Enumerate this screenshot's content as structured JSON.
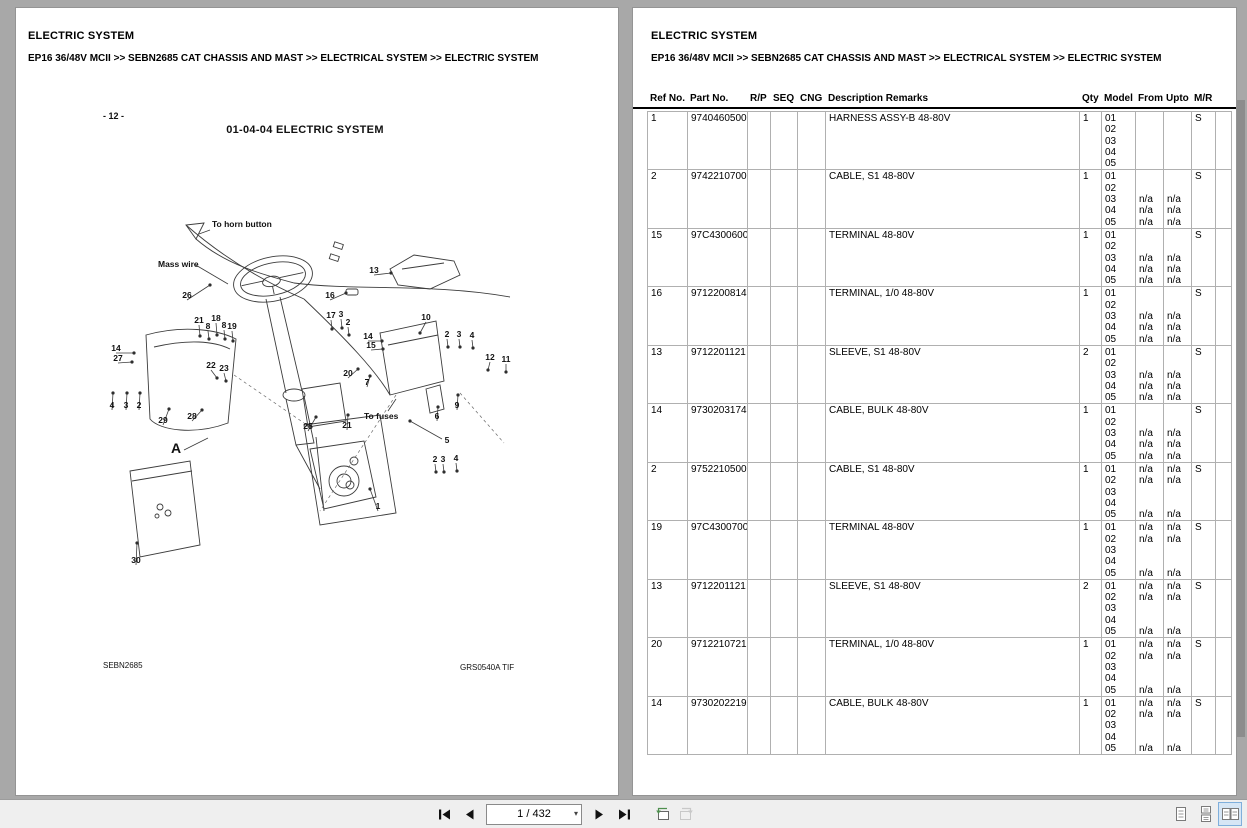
{
  "left_page": {
    "title": "ELECTRIC SYSTEM",
    "breadcrumb": "EP16 36/48V MCII >> SEBN2685 CAT CHASSIS AND MAST >> ELECTRICAL SYSTEM >> ELECTRIC SYSTEM",
    "diagram": {
      "page_number": "- 12 -",
      "title": "01-04-04 ELECTRIC SYSTEM",
      "footer_left": "SEBN2685",
      "footer_right": "GRS0540A TIF",
      "callouts": [
        {
          "t": "To horn button",
          "kind": "text",
          "x": 154,
          "y": 134,
          "sx": 152,
          "sy": 137,
          "ex": 141,
          "ey": 141
        },
        {
          "t": "Mass wire",
          "kind": "text",
          "x": 100,
          "y": 174,
          "sx": 136,
          "sy": 171,
          "ex": 170,
          "ey": 191
        },
        {
          "t": "26",
          "kind": "number",
          "x": 129,
          "y": 205,
          "ex": 152,
          "ey": 192
        },
        {
          "t": "21",
          "kind": "number",
          "x": 141,
          "y": 230,
          "ex": 142,
          "ey": 243
        },
        {
          "t": "8",
          "kind": "number",
          "x": 150,
          "y": 236,
          "ex": 151,
          "ey": 246
        },
        {
          "t": "18",
          "kind": "number",
          "x": 158,
          "y": 228,
          "ex": 159,
          "ey": 242
        },
        {
          "t": "8",
          "kind": "number",
          "x": 166,
          "y": 235,
          "ex": 167,
          "ey": 246
        },
        {
          "t": "19",
          "kind": "number",
          "x": 174,
          "y": 236,
          "ex": 175,
          "ey": 248
        },
        {
          "t": "14",
          "kind": "number",
          "x": 58,
          "y": 258,
          "ex": 76,
          "ey": 260
        },
        {
          "t": "27",
          "kind": "number",
          "x": 60,
          "y": 268,
          "ex": 74,
          "ey": 269
        },
        {
          "t": "16",
          "kind": "number",
          "x": 272,
          "y": 205,
          "ex": 288,
          "ey": 200
        },
        {
          "t": "17",
          "kind": "number",
          "x": 273,
          "y": 225,
          "ex": 274,
          "ey": 236
        },
        {
          "t": "3",
          "kind": "number",
          "x": 283,
          "y": 224,
          "ex": 284,
          "ey": 235
        },
        {
          "t": "2",
          "kind": "number",
          "x": 290,
          "y": 232,
          "ex": 291,
          "ey": 242
        },
        {
          "t": "13",
          "kind": "number",
          "x": 316,
          "y": 180,
          "ex": 333,
          "ey": 180
        },
        {
          "t": "10",
          "kind": "number",
          "x": 368,
          "y": 227,
          "ex": 362,
          "ey": 240
        },
        {
          "t": "14",
          "kind": "number",
          "x": 310,
          "y": 246,
          "ex": 324,
          "ey": 248
        },
        {
          "t": "15",
          "kind": "number",
          "x": 313,
          "y": 255,
          "ex": 325,
          "ey": 256
        },
        {
          "t": "2",
          "kind": "number",
          "x": 389,
          "y": 244,
          "ex": 390,
          "ey": 254
        },
        {
          "t": "3",
          "kind": "number",
          "x": 401,
          "y": 244,
          "ex": 402,
          "ey": 254
        },
        {
          "t": "4",
          "kind": "number",
          "x": 414,
          "y": 245,
          "ex": 415,
          "ey": 255
        },
        {
          "t": "12",
          "kind": "number",
          "x": 432,
          "y": 267,
          "ex": 430,
          "ey": 277
        },
        {
          "t": "11",
          "kind": "number",
          "x": 448,
          "y": 269,
          "ex": 448,
          "ey": 279
        },
        {
          "t": "20",
          "kind": "number",
          "x": 290,
          "y": 283,
          "ex": 300,
          "ey": 276
        },
        {
          "t": "7",
          "kind": "number",
          "x": 309,
          "y": 292,
          "ex": 312,
          "ey": 283
        },
        {
          "t": "22",
          "kind": "number",
          "x": 153,
          "y": 275,
          "ex": 159,
          "ey": 285
        },
        {
          "t": "23",
          "kind": "number",
          "x": 166,
          "y": 278,
          "ex": 168,
          "ey": 288
        },
        {
          "t": "28",
          "kind": "number",
          "x": 134,
          "y": 326,
          "ex": 144,
          "ey": 317
        },
        {
          "t": "29",
          "kind": "number",
          "x": 105,
          "y": 330,
          "ex": 111,
          "ey": 316
        },
        {
          "t": "4",
          "kind": "number",
          "x": 54,
          "y": 315,
          "ex": 55,
          "ey": 300
        },
        {
          "t": "3",
          "kind": "number",
          "x": 68,
          "y": 315,
          "ex": 69,
          "ey": 300
        },
        {
          "t": "2",
          "kind": "number",
          "x": 81,
          "y": 315,
          "ex": 82,
          "ey": 300
        },
        {
          "t": "A",
          "kind": "letter",
          "x": 118,
          "y": 360,
          "sx": 126,
          "sy": 357,
          "ex": 150,
          "ey": 345
        },
        {
          "t": "25",
          "kind": "number",
          "x": 250,
          "y": 336,
          "ex": 258,
          "ey": 324
        },
        {
          "t": "21",
          "kind": "number",
          "x": 289,
          "y": 335,
          "ex": 290,
          "ey": 322
        },
        {
          "t": "To fuses",
          "kind": "text",
          "x": 306,
          "y": 326,
          "sx": 330,
          "sy": 318,
          "ex": 338,
          "ey": 306
        },
        {
          "t": "6",
          "kind": "number",
          "x": 379,
          "y": 326,
          "ex": 380,
          "ey": 314
        },
        {
          "t": "9",
          "kind": "number",
          "x": 399,
          "y": 315,
          "ex": 400,
          "ey": 302
        },
        {
          "t": "5",
          "kind": "number",
          "x": 389,
          "y": 350,
          "sx": 384,
          "sy": 346,
          "ex": 352,
          "ey": 328
        },
        {
          "t": "2",
          "kind": "number",
          "x": 377,
          "y": 369,
          "ex": 378,
          "ey": 379
        },
        {
          "t": "3",
          "kind": "number",
          "x": 385,
          "y": 369,
          "ex": 386,
          "ey": 379
        },
        {
          "t": "4",
          "kind": "number",
          "x": 398,
          "y": 368,
          "ex": 399,
          "ey": 378
        },
        {
          "t": "1",
          "kind": "number",
          "x": 320,
          "y": 416,
          "ex": 312,
          "ey": 396
        },
        {
          "t": "30",
          "kind": "number",
          "x": 78,
          "y": 470,
          "ex": 79,
          "ey": 450
        }
      ]
    }
  },
  "right_page": {
    "title": "ELECTRIC SYSTEM",
    "breadcrumb": "EP16 36/48V MCII >> SEBN2685 CAT CHASSIS AND MAST >> ELECTRICAL SYSTEM >> ELECTRIC SYSTEM",
    "table": {
      "columns": [
        "Ref No.",
        "Part No.",
        "R/P",
        "SEQ",
        "CNG",
        "Description Remarks",
        "Qty",
        "Model",
        "From",
        "Upto",
        "M/R"
      ],
      "rows": [
        {
          "ref": "1",
          "part": "9740460500",
          "rp": "",
          "seq": "",
          "cng": "",
          "desc": "HARNESS ASSY-B 48-80V",
          "qty": "1",
          "model": [
            "01",
            "02",
            "03",
            "04",
            "05"
          ],
          "from": [
            "",
            "",
            "",
            "",
            ""
          ],
          "upto": [
            "",
            "",
            "",
            "",
            ""
          ],
          "mr": "S"
        },
        {
          "ref": "2",
          "part": "9742210700",
          "rp": "",
          "seq": "",
          "cng": "",
          "desc": "CABLE, S1 48-80V",
          "qty": "1",
          "model": [
            "01",
            "02",
            "03",
            "04",
            "05"
          ],
          "from": [
            "",
            "",
            "n/a",
            "n/a",
            "n/a"
          ],
          "upto": [
            "",
            "",
            "n/a",
            "n/a",
            "n/a"
          ],
          "mr": "S"
        },
        {
          "ref": "15",
          "part": "97C4300600",
          "rp": "",
          "seq": "",
          "cng": "",
          "desc": "TERMINAL 48-80V",
          "qty": "1",
          "model": [
            "01",
            "02",
            "03",
            "04",
            "05"
          ],
          "from": [
            "",
            "",
            "n/a",
            "n/a",
            "n/a"
          ],
          "upto": [
            "",
            "",
            "n/a",
            "n/a",
            "n/a"
          ],
          "mr": "S"
        },
        {
          "ref": "16",
          "part": "9712200814",
          "rp": "",
          "seq": "",
          "cng": "",
          "desc": "TERMINAL, 1/0 48-80V",
          "qty": "1",
          "model": [
            "01",
            "02",
            "03",
            "04",
            "05"
          ],
          "from": [
            "",
            "",
            "n/a",
            "n/a",
            "n/a"
          ],
          "upto": [
            "",
            "",
            "n/a",
            "n/a",
            "n/a"
          ],
          "mr": "S"
        },
        {
          "ref": "13",
          "part": "9712201121",
          "rp": "",
          "seq": "",
          "cng": "",
          "desc": "SLEEVE, S1 48-80V",
          "qty": "2",
          "model": [
            "01",
            "02",
            "03",
            "04",
            "05"
          ],
          "from": [
            "",
            "",
            "n/a",
            "n/a",
            "n/a"
          ],
          "upto": [
            "",
            "",
            "n/a",
            "n/a",
            "n/a"
          ],
          "mr": "S"
        },
        {
          "ref": "14",
          "part": "9730203174",
          "rp": "",
          "seq": "",
          "cng": "",
          "desc": "CABLE, BULK 48-80V",
          "qty": "1",
          "model": [
            "01",
            "02",
            "03",
            "04",
            "05"
          ],
          "from": [
            "",
            "",
            "n/a",
            "n/a",
            "n/a"
          ],
          "upto": [
            "",
            "",
            "n/a",
            "n/a",
            "n/a"
          ],
          "mr": "S"
        },
        {
          "ref": "2",
          "part": "9752210500",
          "rp": "",
          "seq": "",
          "cng": "",
          "desc": "CABLE, S1 48-80V",
          "qty": "1",
          "model": [
            "01",
            "02",
            "03",
            "04",
            "05"
          ],
          "from": [
            "n/a",
            "n/a",
            "",
            "",
            "n/a"
          ],
          "upto": [
            "n/a",
            "n/a",
            "",
            "",
            "n/a"
          ],
          "mr": "S"
        },
        {
          "ref": "19",
          "part": "97C4300700",
          "rp": "",
          "seq": "",
          "cng": "",
          "desc": "TERMINAL 48-80V",
          "qty": "1",
          "model": [
            "01",
            "02",
            "03",
            "04",
            "05"
          ],
          "from": [
            "n/a",
            "n/a",
            "",
            "",
            "n/a"
          ],
          "upto": [
            "n/a",
            "n/a",
            "",
            "",
            "n/a"
          ],
          "mr": "S"
        },
        {
          "ref": "13",
          "part": "9712201121",
          "rp": "",
          "seq": "",
          "cng": "",
          "desc": "SLEEVE, S1 48-80V",
          "qty": "2",
          "model": [
            "01",
            "02",
            "03",
            "04",
            "05"
          ],
          "from": [
            "n/a",
            "n/a",
            "",
            "",
            "n/a"
          ],
          "upto": [
            "n/a",
            "n/a",
            "",
            "",
            "n/a"
          ],
          "mr": "S"
        },
        {
          "ref": "20",
          "part": "9712210721",
          "rp": "",
          "seq": "",
          "cng": "",
          "desc": "TERMINAL, 1/0 48-80V",
          "qty": "1",
          "model": [
            "01",
            "02",
            "03",
            "04",
            "05"
          ],
          "from": [
            "n/a",
            "n/a",
            "",
            "",
            "n/a"
          ],
          "upto": [
            "n/a",
            "n/a",
            "",
            "",
            "n/a"
          ],
          "mr": "S"
        },
        {
          "ref": "14",
          "part": "9730202219",
          "rp": "",
          "seq": "",
          "cng": "",
          "desc": "CABLE, BULK 48-80V",
          "qty": "1",
          "model": [
            "01",
            "02",
            "03",
            "04",
            "05"
          ],
          "from": [
            "n/a",
            "n/a",
            "",
            "",
            "n/a"
          ],
          "upto": [
            "n/a",
            "n/a",
            "",
            "",
            "n/a"
          ],
          "mr": "S"
        }
      ]
    }
  },
  "toolbar": {
    "page_indicator": "1 / 432",
    "icons": {
      "first": "first-page-icon",
      "previous": "previous-page-icon",
      "next": "next-page-icon",
      "last": "last-page-icon",
      "previous_view": "previous-view-icon",
      "next_view": "next-view-icon",
      "single_page": "single-page-view-icon",
      "continuous": "continuous-view-icon",
      "facing_pages": "facing-pages-view-icon"
    }
  },
  "colors": {
    "background": "#a8a8a8",
    "page": "#ffffff",
    "toolbar": "#efefef",
    "selected_view_button": "#d6e6f5",
    "table_grid": "#b0b0b0"
  }
}
